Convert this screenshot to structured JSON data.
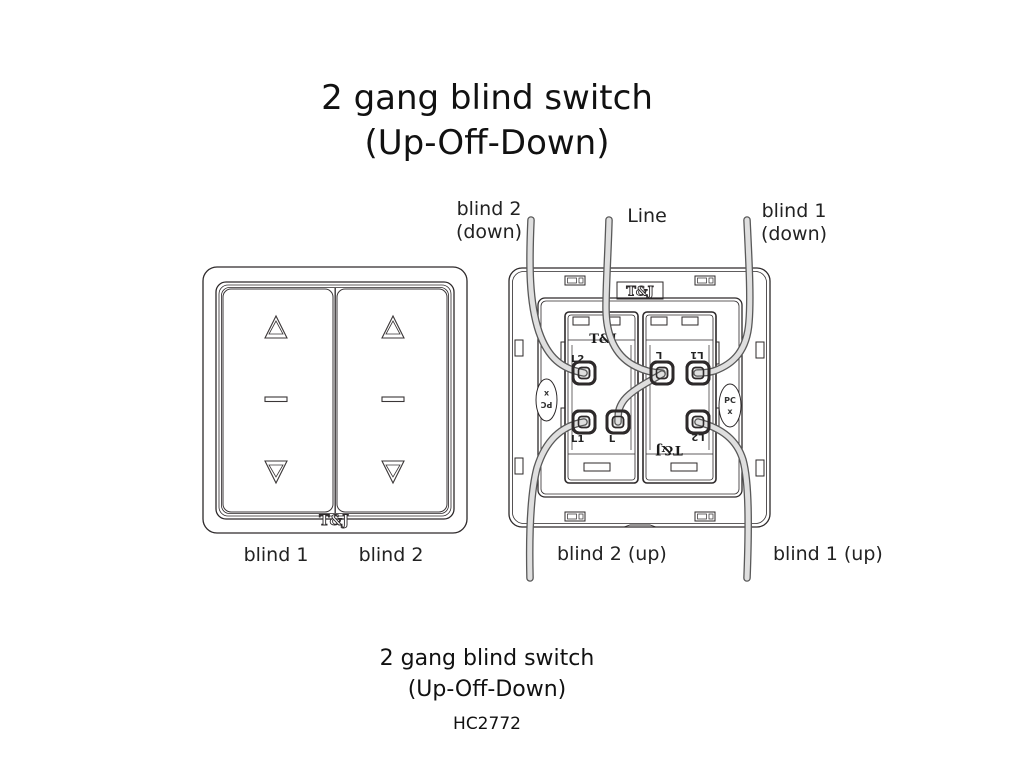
{
  "title": {
    "line1": "2 gang blind switch",
    "line2": "(Up-Off-Down)"
  },
  "front_view": {
    "brand": "T&J",
    "label_left": "blind 1",
    "label_right": "blind 2"
  },
  "back_view": {
    "plate_brand": "T&J",
    "left_module": {
      "brand": "T&J",
      "terminal_top": "L2",
      "terminal_bottom_left": "L1",
      "terminal_bottom_mid": "L"
    },
    "right_module": {
      "brand": "T&J",
      "terminal_top_left": "L",
      "terminal_top_right": "L1",
      "terminal_bottom_right": "L2"
    },
    "side_mark_left": {
      "line1": "PC",
      "line2": "x"
    },
    "side_mark_right": {
      "line1": "PC",
      "line2": "x"
    },
    "labels": {
      "blind2_down_line1": "blind 2",
      "blind2_down_line2": "(down)",
      "line": "Line",
      "blind1_down_line1": "blind 1",
      "blind1_down_line2": "(down)",
      "blind2_up": "blind 2 (up)",
      "blind1_up": "blind 1 (up)"
    }
  },
  "caption": {
    "line1": "2 gang blind switch",
    "line2": "(Up-Off-Down)",
    "model": "HC2772"
  },
  "colors": {
    "background": "#ffffff",
    "line_stroke": "#2d292a",
    "wire_fill": "#dfdfdf",
    "wire_outline": "#595959",
    "text": "#1c1c1c"
  }
}
